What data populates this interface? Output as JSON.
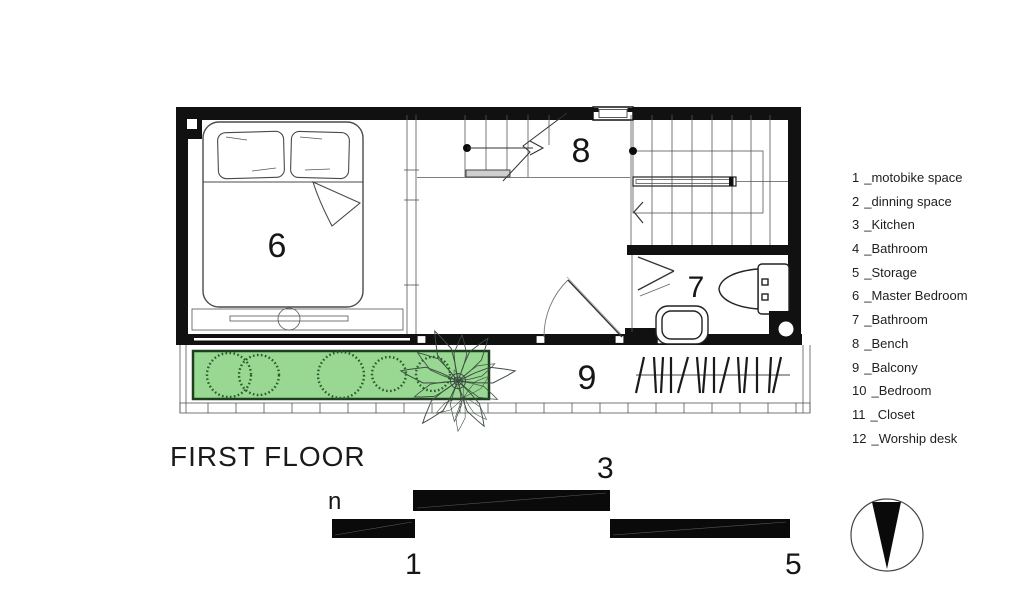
{
  "title": "FIRST FLOOR",
  "plan": {
    "room_numbers": {
      "master_bedroom": "6",
      "bench": "8",
      "bathroom": "7",
      "balcony": "9"
    }
  },
  "section": {
    "label_n": "n",
    "label_1": "1",
    "label_3": "3",
    "label_5": "5"
  },
  "legend": {
    "items": [
      {
        "num": "1",
        "name": "_motobike space"
      },
      {
        "num": "2",
        "name": "_dinning space"
      },
      {
        "num": "3",
        "name": "_Kitchen"
      },
      {
        "num": "4",
        "name": "_Bathroom"
      },
      {
        "num": "5",
        "name": "_Storage"
      },
      {
        "num": "6",
        "name": "_Master Bedroom"
      },
      {
        "num": "7",
        "name": "_Bathroom"
      },
      {
        "num": "8",
        "name": "_Bench"
      },
      {
        "num": "9",
        "name": "_Balcony"
      },
      {
        "num": "10",
        "name": "_Bedroom"
      },
      {
        "num": "11",
        "name": "_Closet"
      },
      {
        "num": "12",
        "name": "_Worship desk"
      }
    ]
  },
  "colors": {
    "planter_fill": "#98d893",
    "planter_stroke": "#1e3f1e",
    "ink": "#111111"
  }
}
